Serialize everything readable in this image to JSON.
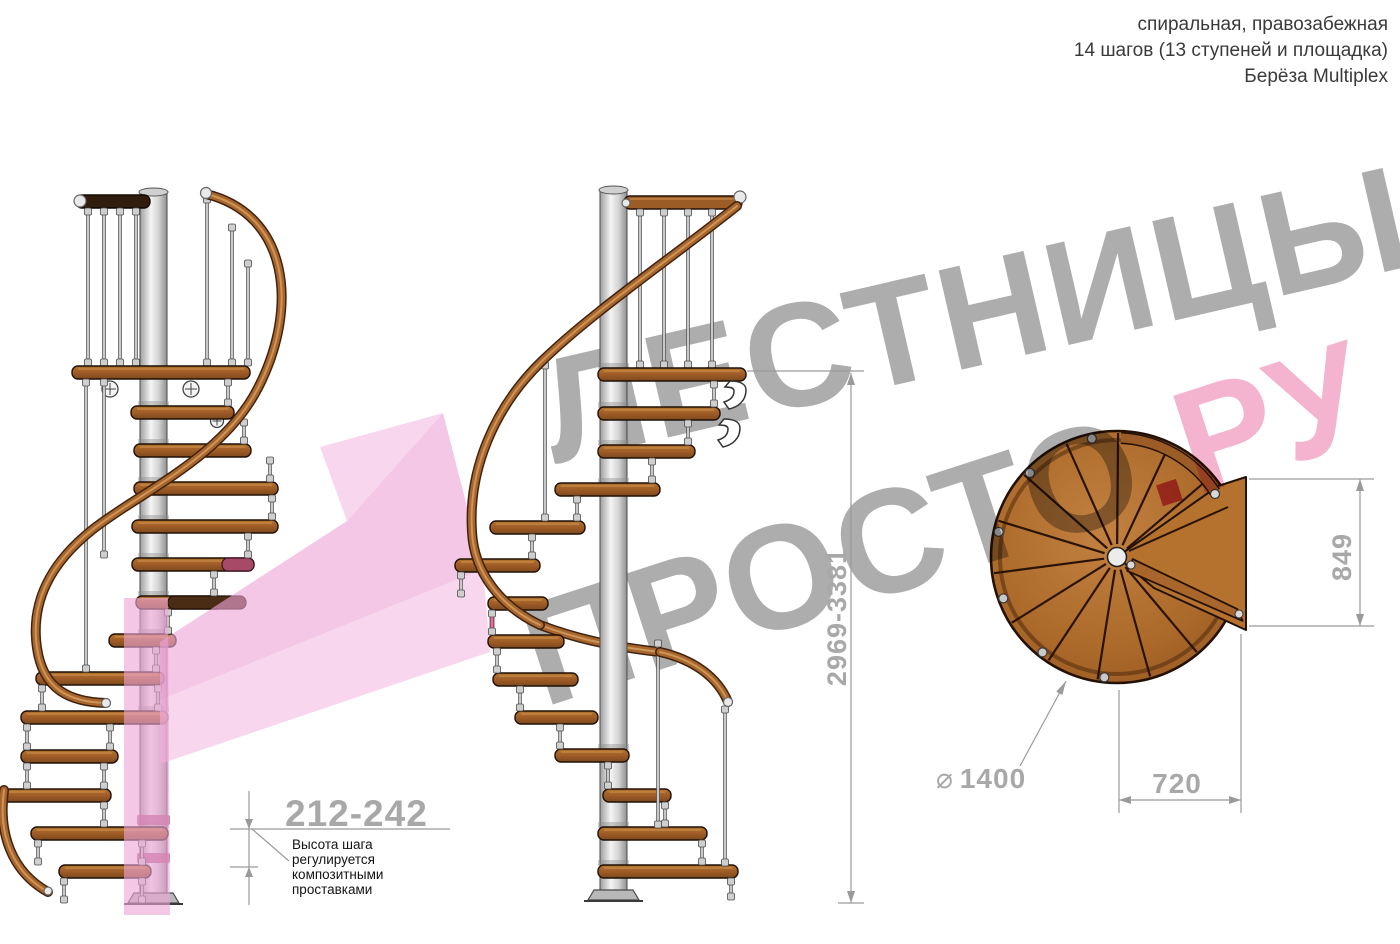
{
  "info": {
    "line1": "спиральная, правозабежная",
    "line2": "14 шагов (13 ступеней и площадка)",
    "line3": "Берёза Multiplex"
  },
  "watermark": {
    "word1": "ЛЕСТНИЦЫ",
    "word2": "ПРОСТО",
    "dot": ".",
    "word3": "РУ"
  },
  "dims": {
    "step_height": "212-242",
    "step_note": [
      "Высота шага",
      "регулируется",
      "композитными",
      "проставками"
    ],
    "total_height": "2969-3381",
    "landing_depth": "849",
    "landing_width": "720",
    "diameter_symbol": "⌀",
    "diameter": "1400"
  },
  "colors": {
    "watermark_gray": "#9b9b9b",
    "watermark_pink": "#f2a3c6",
    "watermark_dot": "#c9356b",
    "dimension_gray": "#9a9a9a",
    "wood": "#a8652c",
    "dark_wood": "#301d0e",
    "pole_gray": "#d9d9d9",
    "arrow_pink_light": "#f3bfe4",
    "arrow_pink_mid": "#eea4d7",
    "accent_crimson": "#a64a68"
  }
}
